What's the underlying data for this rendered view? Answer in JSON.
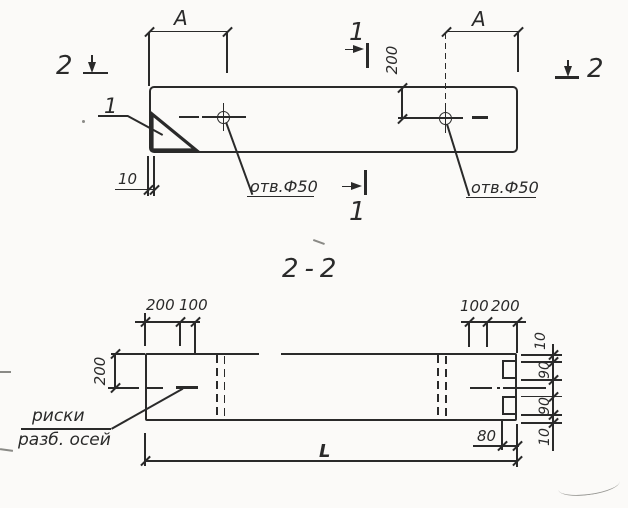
{
  "meta": {
    "ink_color": "#2a2a2a",
    "paper_color": "#fbfaf8",
    "drawing_type": "technical drawing, beam with lifting holes"
  },
  "plan_view": {
    "dim_a_left": "A",
    "dim_a_right": "A",
    "section_cut_2_left": "2",
    "section_cut_2_right": "2",
    "section_cut_1_top": "1",
    "section_cut_1_bottom": "1",
    "detail_ref": "1",
    "dim_edge_to_hole": "200",
    "dim_end_offset": "10",
    "hole_label_left": "отв.Ф50",
    "hole_label_right": "отв.Ф50"
  },
  "section_view": {
    "title": "2-2",
    "dim_top_left_200": "200",
    "dim_top_left_100": "100",
    "dim_top_right_100": "100",
    "dim_top_right_200": "200",
    "dim_left_200": "200",
    "side_dims": [
      "10",
      "90",
      "90",
      "10"
    ],
    "dim_notch_depth_80": "80",
    "dim_length": "L",
    "axis_note_line1": "риски",
    "axis_note_line2": "разб. осей"
  }
}
